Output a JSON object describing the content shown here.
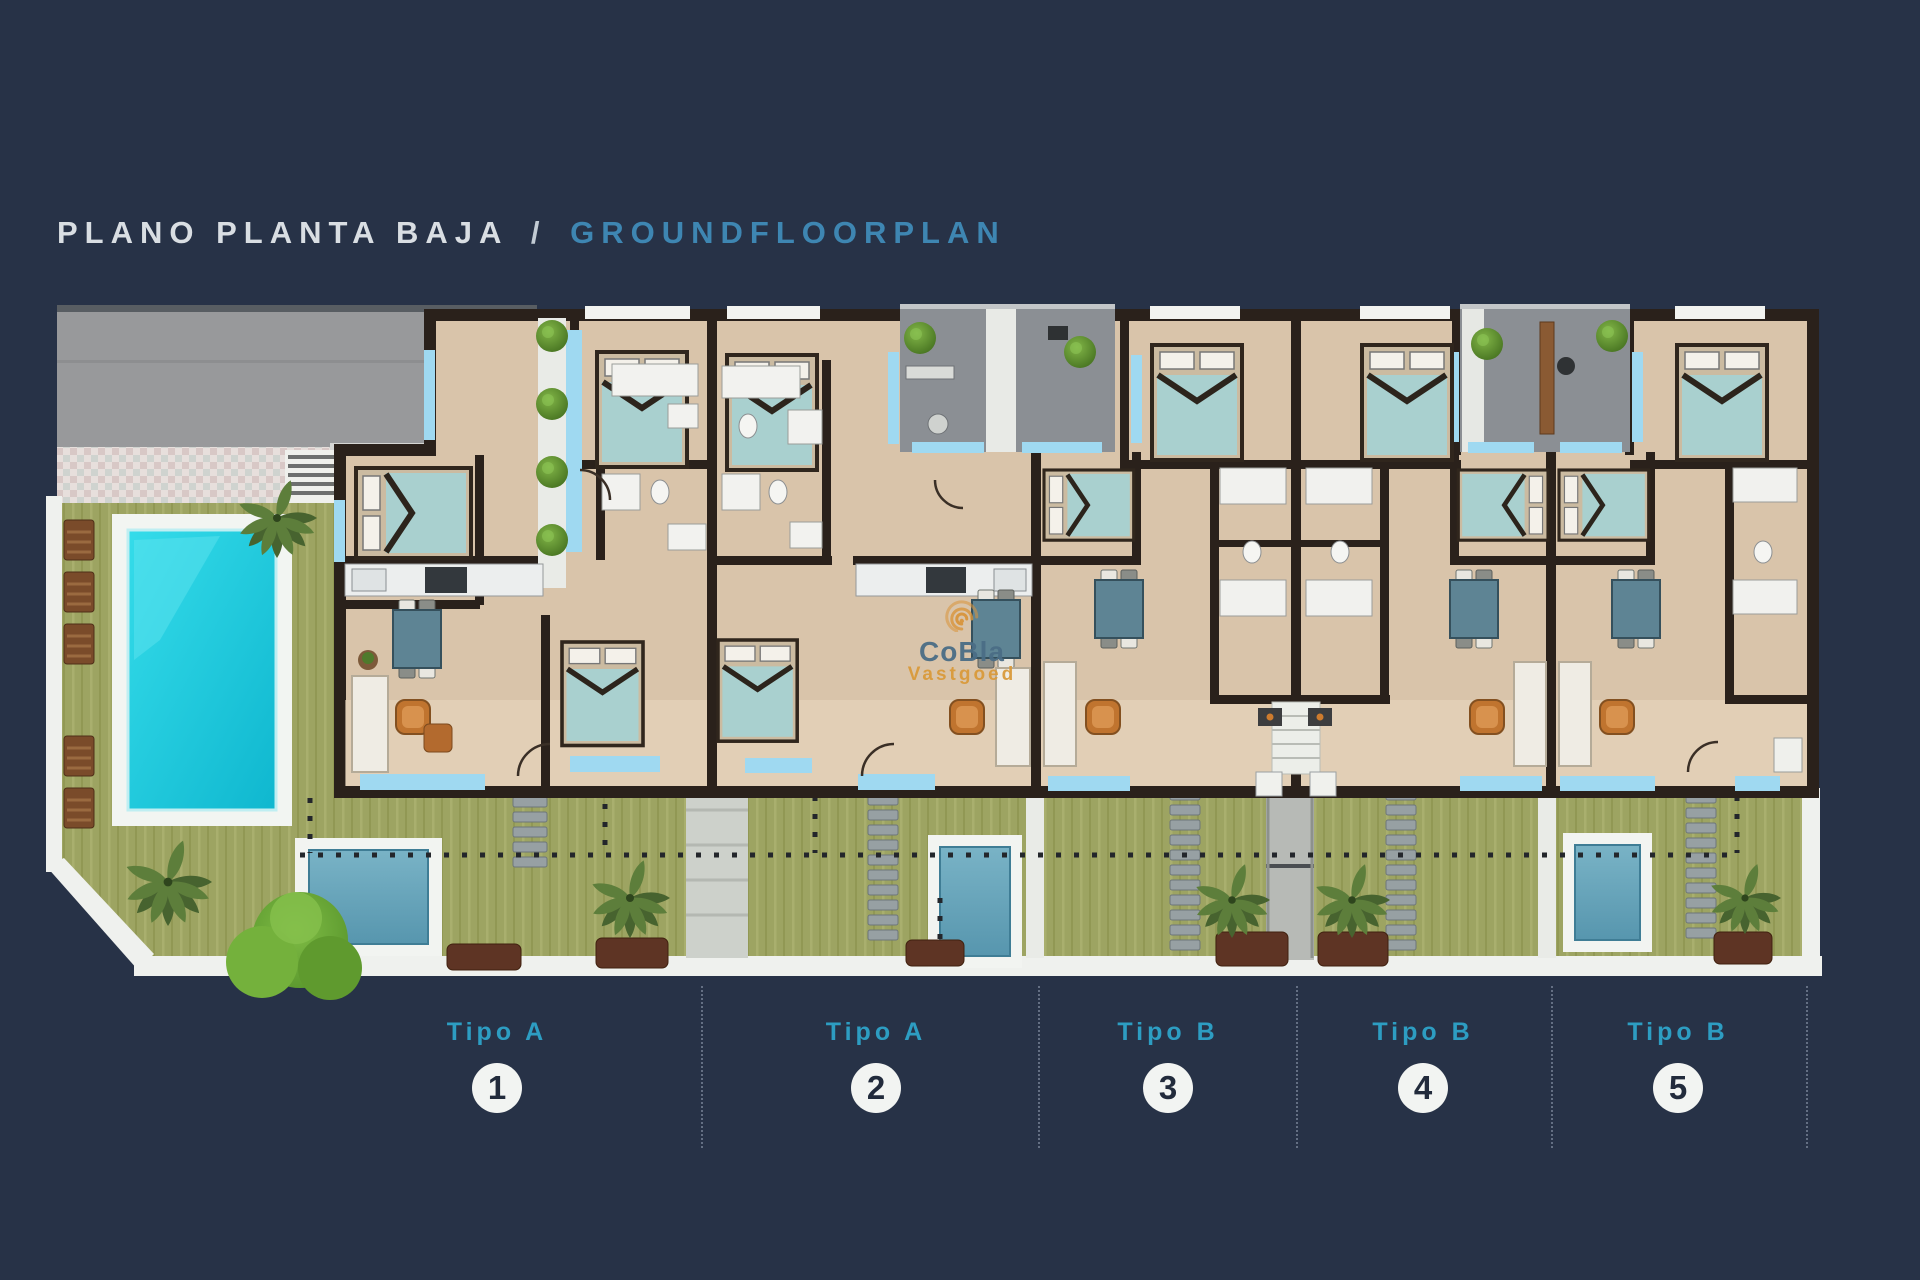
{
  "title": {
    "es": "PLANO PLANTA BAJA",
    "separator": "/",
    "en": "GROUNDFLOORPLAN"
  },
  "watermark": {
    "name": "CoBla",
    "tagline": "Vastgoed",
    "logo": "spiral-logo"
  },
  "units": [
    {
      "type_label": "Tipo A",
      "number": "1"
    },
    {
      "type_label": "Tipo A",
      "number": "2"
    },
    {
      "type_label": "Tipo B",
      "number": "3"
    },
    {
      "type_label": "Tipo B",
      "number": "4"
    },
    {
      "type_label": "Tipo B",
      "number": "5"
    }
  ],
  "colors": {
    "background_navy": "#273247",
    "title_white": "#d9dee3",
    "title_blue": "#3e86b2",
    "label_blue": "#2d9dc2",
    "pool_cyan": "#24d2e4",
    "plunge_pool_blue": "#6aa7bd",
    "lawn_olive": "#9da462",
    "floor_beige": "#d9c4aa",
    "wall_dark": "#2a211b",
    "window_light_blue": "#9fd9f1",
    "courtyard_gray": "#8b8f94",
    "driveway_gray": "#98999b",
    "watermark_orange": "#d99a3b",
    "watermark_blue": "#4a6d86"
  },
  "plan_features": [
    "driveway",
    "communal-swimming-pool",
    "sun-loungers",
    "palm-trees",
    "lawn-gardens",
    "private-plunge-pools",
    "garden-stairs",
    "entrance-courtyards",
    "five-apartment-units",
    "dotted-property-boundaries"
  ]
}
